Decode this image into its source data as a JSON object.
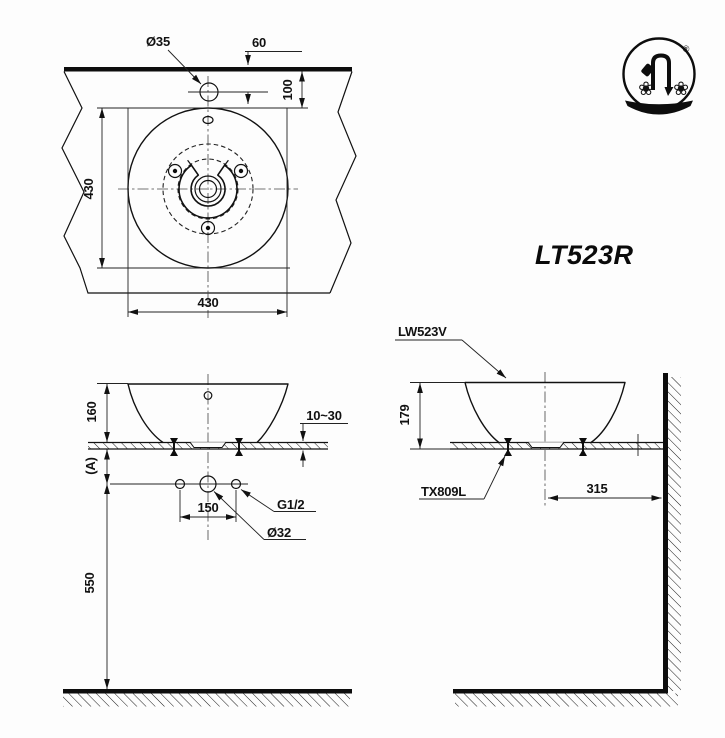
{
  "page": {
    "background": "#fdfdfd",
    "line_color": "#111111"
  },
  "model_code": "LT523R",
  "logo": {
    "registered_mark": "®"
  },
  "plan_view": {
    "faucet_hole_dia": "Ø35",
    "faucet_hole_offset": "60",
    "wall_to_basin": "100",
    "basin_depth": "430",
    "basin_width": "430"
  },
  "front_view": {
    "basin_height": "160",
    "counter_offset": "(A)",
    "counter_thickness": "10~30",
    "hole_spacing": "150",
    "supply_thread": "G1/2",
    "drain_dia": "Ø32",
    "supply_height": "550"
  },
  "side_view": {
    "basin_model": "LW523V",
    "basin_height": "179",
    "faucet_model": "TX809L",
    "wall_distance": "315"
  }
}
